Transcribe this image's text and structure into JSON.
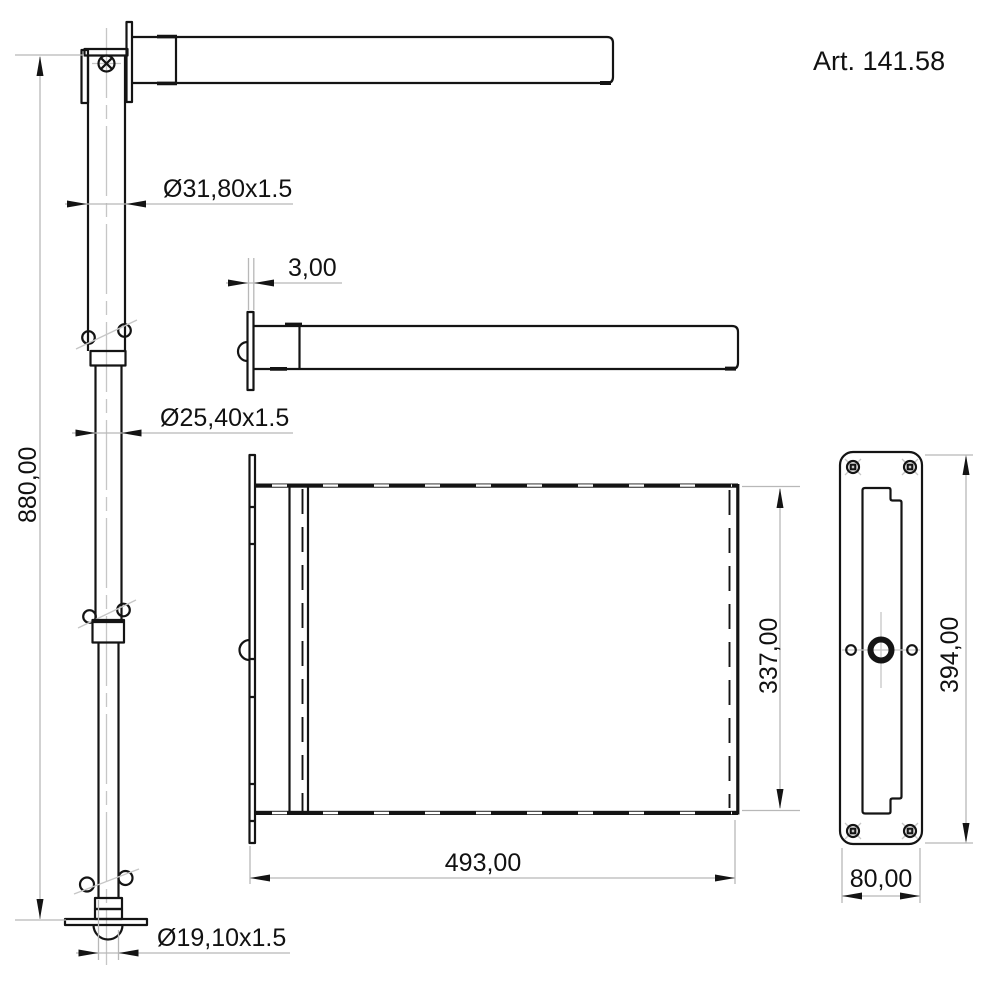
{
  "article_label": "Art. 141.58",
  "dimensions": {
    "pole_height": "880,00",
    "upper_tube_diameter": "Ø31,80x1.5",
    "middle_tube_diameter": "Ø25,40x1.5",
    "lower_tube_diameter": "Ø19,10x1.5",
    "flange_thickness": "3,00",
    "panel_width": "493,00",
    "panel_height": "337,00",
    "wall_plate_height": "394,00",
    "wall_plate_width": "80,00"
  },
  "colors": {
    "line": "#141414",
    "dimension_line": "#b8b8b8",
    "background": "#ffffff"
  }
}
